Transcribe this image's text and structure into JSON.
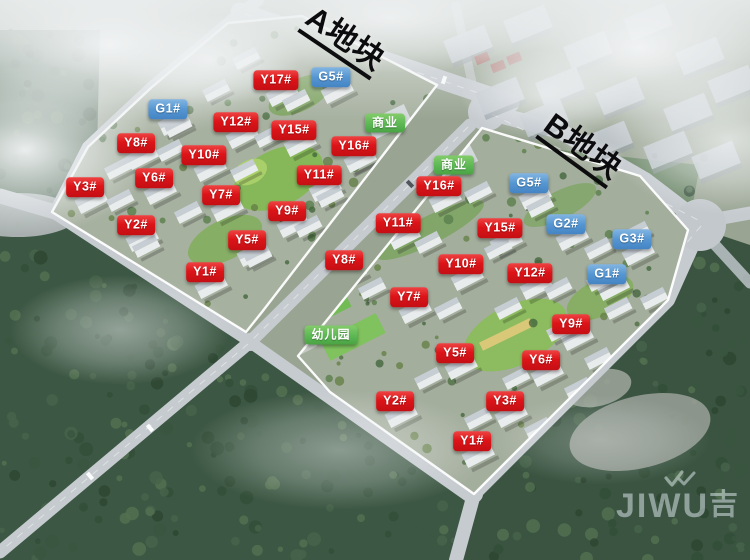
{
  "plots": [
    {
      "id": "A",
      "title": "A地块",
      "labels": [
        {
          "text": "G1#",
          "color": "blue",
          "x": 168,
          "y": 109
        },
        {
          "text": "Y17#",
          "color": "red",
          "x": 276,
          "y": 80
        },
        {
          "text": "G5#",
          "color": "blue",
          "x": 331,
          "y": 77
        },
        {
          "text": "Y12#",
          "color": "red",
          "x": 236,
          "y": 122
        },
        {
          "text": "Y15#",
          "color": "red",
          "x": 294,
          "y": 130
        },
        {
          "text": "商业",
          "color": "green",
          "x": 385,
          "y": 123
        },
        {
          "text": "Y16#",
          "color": "red",
          "x": 354,
          "y": 146
        },
        {
          "text": "Y8#",
          "color": "red",
          "x": 136,
          "y": 143
        },
        {
          "text": "Y10#",
          "color": "red",
          "x": 204,
          "y": 155
        },
        {
          "text": "Y11#",
          "color": "red",
          "x": 319,
          "y": 175
        },
        {
          "text": "Y6#",
          "color": "red",
          "x": 154,
          "y": 178
        },
        {
          "text": "Y3#",
          "color": "red",
          "x": 85,
          "y": 187
        },
        {
          "text": "Y7#",
          "color": "red",
          "x": 221,
          "y": 195
        },
        {
          "text": "Y9#",
          "color": "red",
          "x": 287,
          "y": 211
        },
        {
          "text": "Y2#",
          "color": "red",
          "x": 136,
          "y": 225
        },
        {
          "text": "Y5#",
          "color": "red",
          "x": 247,
          "y": 240
        },
        {
          "text": "Y1#",
          "color": "red",
          "x": 205,
          "y": 272
        }
      ]
    },
    {
      "id": "B",
      "title": "B地块",
      "labels": [
        {
          "text": "商业",
          "color": "green",
          "x": 454,
          "y": 165
        },
        {
          "text": "Y16#",
          "color": "red",
          "x": 439,
          "y": 186
        },
        {
          "text": "G5#",
          "color": "blue",
          "x": 529,
          "y": 183
        },
        {
          "text": "Y11#",
          "color": "red",
          "x": 398,
          "y": 223
        },
        {
          "text": "Y15#",
          "color": "red",
          "x": 500,
          "y": 228
        },
        {
          "text": "G2#",
          "color": "blue",
          "x": 566,
          "y": 224
        },
        {
          "text": "G3#",
          "color": "blue",
          "x": 632,
          "y": 239
        },
        {
          "text": "Y8#",
          "color": "red",
          "x": 344,
          "y": 260
        },
        {
          "text": "Y10#",
          "color": "red",
          "x": 461,
          "y": 264
        },
        {
          "text": "Y12#",
          "color": "red",
          "x": 530,
          "y": 273
        },
        {
          "text": "G1#",
          "color": "blue",
          "x": 607,
          "y": 274
        },
        {
          "text": "Y7#",
          "color": "red",
          "x": 409,
          "y": 297
        },
        {
          "text": "Y9#",
          "color": "red",
          "x": 571,
          "y": 324
        },
        {
          "text": "幼儿园",
          "color": "green",
          "x": 331,
          "y": 335
        },
        {
          "text": "Y5#",
          "color": "red",
          "x": 455,
          "y": 353
        },
        {
          "text": "Y6#",
          "color": "red",
          "x": 541,
          "y": 360
        },
        {
          "text": "Y2#",
          "color": "red",
          "x": 395,
          "y": 401
        },
        {
          "text": "Y3#",
          "color": "red",
          "x": 505,
          "y": 401
        },
        {
          "text": "Y1#",
          "color": "red",
          "x": 472,
          "y": 441
        }
      ]
    }
  ],
  "label_colors": {
    "red": "#dc1418",
    "blue": "#5596d2",
    "green": "#5cb854"
  },
  "watermark": {
    "brand": "JIWU",
    "cjk": "吉"
  }
}
